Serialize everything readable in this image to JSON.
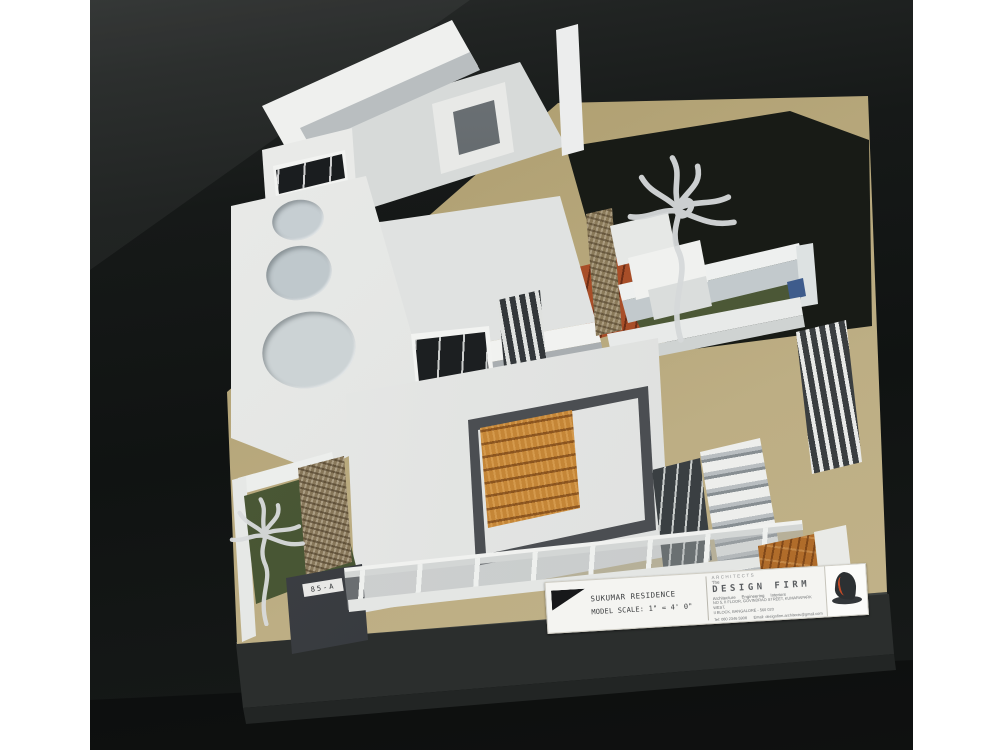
{
  "photo": {
    "description": "architectural scale model photograph"
  },
  "model_label": {
    "project_name": "SUKUMAR RESIDENCE",
    "scale_text": "MODEL SCALE: 1\" = 4' 0\"",
    "architects_heading": "ARCHITECTS",
    "firm_prefix": "The",
    "firm_name": "DESIGN FIRM",
    "firm_services": "Architecture     Engineering     Interiors",
    "address_line1": "NO 5, II FLOOR, GOVINDRAO STREET, KUMARAPARK WEST,",
    "address_line2": "II BLOCK, BANGALORE - 560 020",
    "contact_line": "Tel: 080 2346 5908      Email: designfirm.architects@gmail.com"
  },
  "house_number_plate": {
    "text": "85-A"
  },
  "colors": {
    "board_tan": "#bcad83",
    "backdrop_dark": "#161918",
    "lawn_green": "#4d5938",
    "wood_panel": "#c58637",
    "deck_terracotta": "#a84e28",
    "model_white": "#eceded",
    "frame_charcoal": "#4b4e52",
    "logo_red": "#c44a26"
  }
}
